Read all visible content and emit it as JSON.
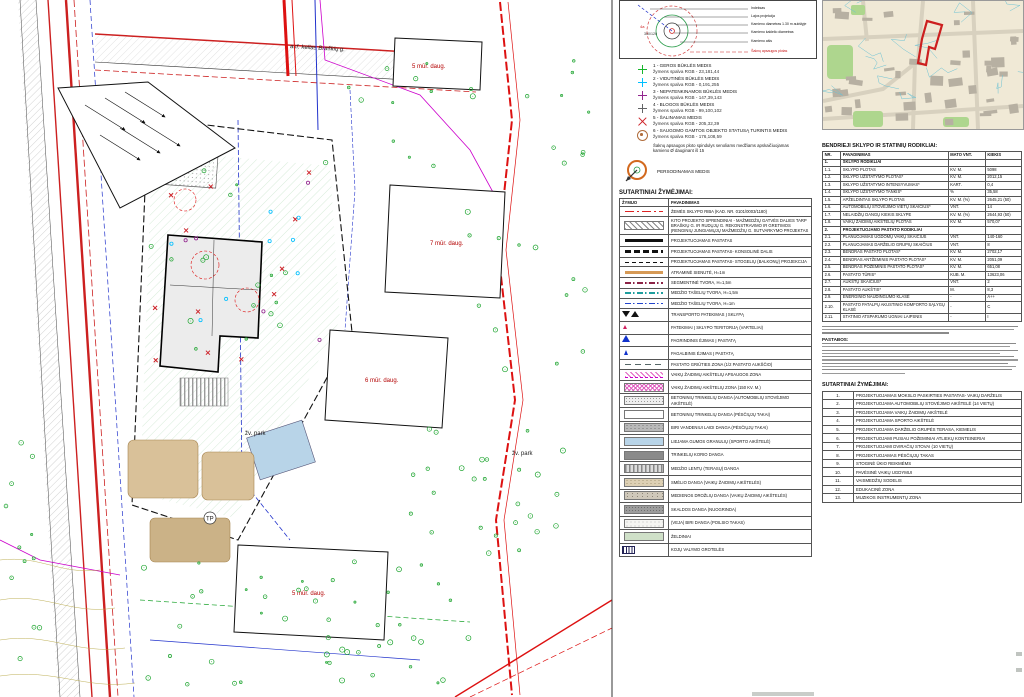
{
  "tree_diagram": {
    "labels": [
      "Indeksas",
      "Lajos projekcija",
      "Kamieno diametras 1.30 m aukštyje",
      "Kamieno kaklelio diametras",
      "Kamieno ašis",
      "Šaknų apsaugos plotas"
    ],
    "index_label": "4a",
    "size_label": "300/120"
  },
  "tree_status_legend": {
    "items": [
      {
        "name": "1 - GEROS BŪKLĖS MEDIS",
        "rgb": "žymens spalva RGB - 23,181,44",
        "symcls": "tsym cross c-green"
      },
      {
        "name": "2 - VIDUTINĖS BŪKLĖS MEDIS",
        "rgb": "žymens spalva RGB - 0,191,255",
        "symcls": "tsym cross c-cyan"
      },
      {
        "name": "3 - NEPATENKINAMOS BŪKLĖS MEDIS",
        "rgb": "žymens spalva RGB - 147,39,143",
        "symcls": "tsym cross c-purple"
      },
      {
        "name": "4 - BLOGOS BŪKLĖS MEDIS",
        "rgb": "žymens spalva RGB - 99,100,102",
        "symcls": "tsym cross c-gray"
      },
      {
        "name": "5 - ŠALINAMAS MEDIS",
        "rgb": "žymens spalva RGB - 205,32,39",
        "symcls": "tsym xmark"
      },
      {
        "name": "6 - SAUGOMO GAMTOS OBJEKTO STATUSĄ TURINTIS MEDIS",
        "rgb": "žymens spalva RGB - 176,108,59",
        "symcls": "tsym target"
      }
    ],
    "note": "Šaknų apsaugos ploto spindulys senoliams medžiams apskaičiuojamas kamieno Ø dauginant iš 15",
    "transplant_label": "PERSODINAMAS MEDIS"
  },
  "mid_symbols": {
    "title": "SUTARTINIAI ŽYMĖJIMAI:",
    "headers": [
      "ŽYMUO",
      "PAVADINIMAS"
    ],
    "rows": [
      {
        "sym": "ln red-dashdot",
        "name": "ŽEMĖS SKLYPO RIBA (KAD. NR. 0101/0003/1180)"
      },
      {
        "sym": "sw hatch",
        "name": "KITO PROJEKTO SPRENDINIAI - MAŽMEDŽIŲ GATVĖS DALIES TARP BRAŠKIŲ G. IR RUDŲJŲ G. REKONSTRAVIMO IR GRETIMOS ĮRENGINIŲ JUNGIAMŲJŲ MAŽMEDŽIŲ G. SUTVARKYMO PROJEKTAS"
      },
      {
        "sym": "ln solid-thick",
        "name": "PROJEKTUOJAMAS PASTATAS"
      },
      {
        "sym": "ln dash-thick",
        "name": "PROJEKTUOJAMAS PASTATAS- KONSOLINĖ DALIS"
      },
      {
        "sym": "ln dash-thin",
        "name": "PROJEKTUOJAMAS PASTATAS- STOGELIŲ (BALKONŲ) PROJEKCIJA"
      },
      {
        "sym": "ln orange",
        "name": "ATRAMINĖ SIENUTĖ, H=1m"
      },
      {
        "sym": "ln fence-maroon",
        "name": "SEGMENTINĖ TVORA, H=1,5m"
      },
      {
        "sym": "ln fence-teal",
        "name": "MEDŽIO TAŠELIŲ TVORA, H=1,5m"
      },
      {
        "sym": "ln fence-blue",
        "name": "MEDŽIO TAŠELIŲ TVORA, H=1m"
      },
      {
        "sym": "glyph tri-pair",
        "name": "TRANSPORTO PATEKIMAS Į SKLYPĄ"
      },
      {
        "sym": "glyph tri-red",
        "name": "PATEKIMAI Į SKLYPO TERITORIJĄ (VARTELIAI)"
      },
      {
        "sym": "glyph tri-blue",
        "name": "PAGRINDINIS ĖJIMAS Į PASTATĄ"
      },
      {
        "sym": "glyph tri-blue-sm",
        "name": "PAGALBINIS ĖJIMAS Į PASTATĄ"
      },
      {
        "sym": "ln dash-gray",
        "name": "PASTATO GRIŪTIES ZONA (1/2 PASTATO AUKŠČIO)"
      },
      {
        "sym": "sw pinkhatch-line",
        "name": "VAIKŲ ŽAIDIMŲ AIKŠTELIŲ APSAUGOS ZONA"
      },
      {
        "sym": "sw pinkhatch",
        "name": "VAIKŲ ŽAIDIMŲ AIKŠTELIŲ ZONA (150 KV. M.)"
      },
      {
        "sym": "sw dots-light",
        "name": "BETONINIŲ TRINKELIŲ DANGA (AUTOMOBILIŲ STOVĖJIMO AIKŠTELĖ)"
      },
      {
        "sym": "sw gray-fine",
        "name": "BETONINIŲ TRINKELIŲ DANGA (PĖSČIŲJŲ TAKAI)"
      },
      {
        "sym": "sw speckle-gray",
        "name": "BIRI VANDENIUI LAIDI DANGA (PĖSČIŲJŲ TAKAI)"
      },
      {
        "sym": "sw fill-blue",
        "name": "LIEJAMA GUMOS GRANULIŲ (SPORTO AIKŠTELĖ)"
      },
      {
        "sym": "sw fill-darkgray",
        "name": "TRINKELIŲ KORIO DANGA"
      },
      {
        "sym": "sw vstripes",
        "name": "MEDŽIO LENTŲ (TERASŲ) DANGA"
      },
      {
        "sym": "sw sand",
        "name": "SMĖLIO DANGA (VAIKŲ ŽAIDIMŲ AIKŠTELĖS)"
      },
      {
        "sym": "sw chips",
        "name": "MEDIENOS DROŽLIŲ DANGA (VAIKŲ ŽAIDIMŲ AIKŠTELĖS)"
      },
      {
        "sym": "sw fill-gray2",
        "name": "SKALDOS DANGA (NUOGRINDA)"
      },
      {
        "sym": "sw fill-white",
        "name": "(VEJA) BIRI DANGA (POILSIO TAKAS)"
      },
      {
        "sym": "sw fill-green",
        "name": "ŽELDINIAI"
      },
      {
        "sym": "glyph grate",
        "name": "KOJŲ VALYMO GROTELĖS"
      }
    ]
  },
  "indicators": {
    "title": "BENDRIEJI SKLYPO IR STATINIŲ RODIKLIAI:",
    "headers": [
      "NR.",
      "PAVADINIMAS",
      "MATO VNT.",
      "KIEKIS"
    ],
    "rows": [
      {
        "nr": "1.",
        "name": "SKLYPO RODIKLIAI",
        "unit": "",
        "qty": "",
        "cls": "sec"
      },
      {
        "nr": "1.1.",
        "name": "SKLYPO PLOTAS",
        "unit": "KV. M.",
        "qty": "5098"
      },
      {
        "nr": "1.2.",
        "name": "SKLYPO UŽSTATYMO PLOTAS*",
        "unit": "KV. M.",
        "qty": "2012,15"
      },
      {
        "nr": "1.3.",
        "name": "SKLYPO UŽSTATYMO INTENSYVUMAS*",
        "unit": "KART.",
        "qty": "0,4"
      },
      {
        "nr": "1.4.",
        "name": "SKLYPO UŽSTATYMO TANKIS*",
        "unit": "%",
        "qty": "35,58"
      },
      {
        "nr": "1.5.",
        "name": "APŽELDINTAS SKLYPO PLOTAS",
        "unit": "KV. M. (%)",
        "qty": "2645,21 (50)"
      },
      {
        "nr": "1.6.",
        "name": "AUTOMOBILIŲ STOVĖJIMO VIETŲ SKAIČIUS*",
        "unit": "VNT.",
        "qty": "14"
      },
      {
        "nr": "1.7.",
        "name": "NELAIDŽIŲ DANGŲ KIEKIS SKLYPE",
        "unit": "KV. M. (%)",
        "qty": "2644,93 (50)"
      },
      {
        "nr": "1.8.",
        "name": "VAIKŲ ŽAIDIMŲ AIKŠTELIŲ PLOTAS",
        "unit": "KV. M.",
        "qty": "570,07"
      },
      {
        "nr": "2.",
        "name": "PROJEKTUOJAMO PASTATO RODIKLIAI",
        "unit": "",
        "qty": "",
        "cls": "sec"
      },
      {
        "nr": "2.1.",
        "name": "PLANUOJAMAS UGDOMŲ VAIKŲ SKAIČIUS",
        "unit": "VNT.",
        "qty": "140-160"
      },
      {
        "nr": "2.2.",
        "name": "PLANUOJAMAS DARŽELIO GRUPIŲ SKAIČIUS",
        "unit": "VNT.",
        "qty": "8"
      },
      {
        "nr": "2.3.",
        "name": "BENDRAS PASTATO PLOTAS*",
        "unit": "KV. M.",
        "qty": "2702,17"
      },
      {
        "nr": "2.4.",
        "name": "BENDRAS ANTŽEMINIS PASTATO PLOTAS*",
        "unit": "KV. M.",
        "qty": "2051,09"
      },
      {
        "nr": "2.5.",
        "name": "BENDRAS POŽEMINIS PASTATO PLOTAS*",
        "unit": "KV. M.",
        "qty": "651,08"
      },
      {
        "nr": "2.6.",
        "name": "PASTATO TŪRIS*",
        "unit": "KUB. M.",
        "qty": "13623,06"
      },
      {
        "nr": "2.7.",
        "name": "AUKŠTŲ SKAIČIUS*",
        "unit": "VNT.",
        "qty": "2"
      },
      {
        "nr": "2.8.",
        "name": "PASTATO AUKŠTIS*",
        "unit": "M.",
        "qty": "8,3"
      },
      {
        "nr": "2.9.",
        "name": "ENERGINIO NAUDINGUMO KLASĖ",
        "unit": "-",
        "qty": "A++"
      },
      {
        "nr": "2.10.",
        "name": "PASTATO PATALPŲ AKUSTINIO KOMFORTO SĄLYGŲ KLASĖ",
        "unit": "-",
        "qty": "C"
      },
      {
        "nr": "2.11.",
        "name": "STATINIO ATSPARUMO UGNIAI LAIPSNIS",
        "unit": "-",
        "qty": "I"
      }
    ]
  },
  "notes": {
    "heading": "PASTABOS:"
  },
  "right_symbols": {
    "title": "SUTARTINIAI ŽYMĖJIMAI:",
    "rows": [
      {
        "nr": "1.",
        "name": "PROJEKTUOJAMAS MOKSLO PASKIRTIES PASTATAS- VAIKŲ DARŽELIS"
      },
      {
        "nr": "2.",
        "name": "PROJEKTUOJAMA AUTOMOBILIŲ STOVĖJIMO AIKŠTELĖ (14 VIETŲ)"
      },
      {
        "nr": "3.",
        "name": "PROJEKTUOJAMA VAIKŲ ŽAIDIMŲ AIKŠTELĖ"
      },
      {
        "nr": "4.",
        "name": "PROJEKTUOJAMA SPORTO AIKŠTELĖ"
      },
      {
        "nr": "5.",
        "name": "PROJEKTUOJAMA DARŽELIO GRUPĖS TERASA, KIEMELIS"
      },
      {
        "nr": "6.",
        "name": "PROJEKTUOJAMI PUSIAU POŽEMINIAI ATLIEKŲ KONTEINERIAI"
      },
      {
        "nr": "7.",
        "name": "PROJEKTUOJAMI DVIRAČIŲ STOVAI (10 VIETŲ)"
      },
      {
        "nr": "8.",
        "name": "PROJEKTUOJAMAS PĖSČIŲJŲ TAKAS"
      },
      {
        "nr": "9.",
        "name": "STOGINĖ ŪKIO REIKMĖMS"
      },
      {
        "nr": "10.",
        "name": "PAVĖSINĖ VAIKŲ UGDYMUI"
      },
      {
        "nr": "11.",
        "name": "VAISMEDŽIŲ SODELIS"
      },
      {
        "nr": "12.",
        "name": "EDUKACINĖ ZONA"
      },
      {
        "nr": "13.",
        "name": "MUZIKOS INSTRUMENTŲ ZONA"
      }
    ]
  },
  "map": {
    "street_label": "asf. kelias  Braškių g.",
    "labels": [
      {
        "text": "5 mūr. daug."
      },
      {
        "text": "7 mūr. daug."
      },
      {
        "text": "6 mūr. daug."
      },
      {
        "text": "5 mūr. daug."
      },
      {
        "text": "žv. park"
      },
      {
        "text": "žv. park"
      },
      {
        "text": "TP"
      }
    ],
    "colors": {
      "boundary": "#dd1111",
      "utility_blue": "#2233cc",
      "utility_magenta": "#cc00cc",
      "tree_green": "#1aa32c",
      "removed_red": "#cd2027"
    }
  }
}
